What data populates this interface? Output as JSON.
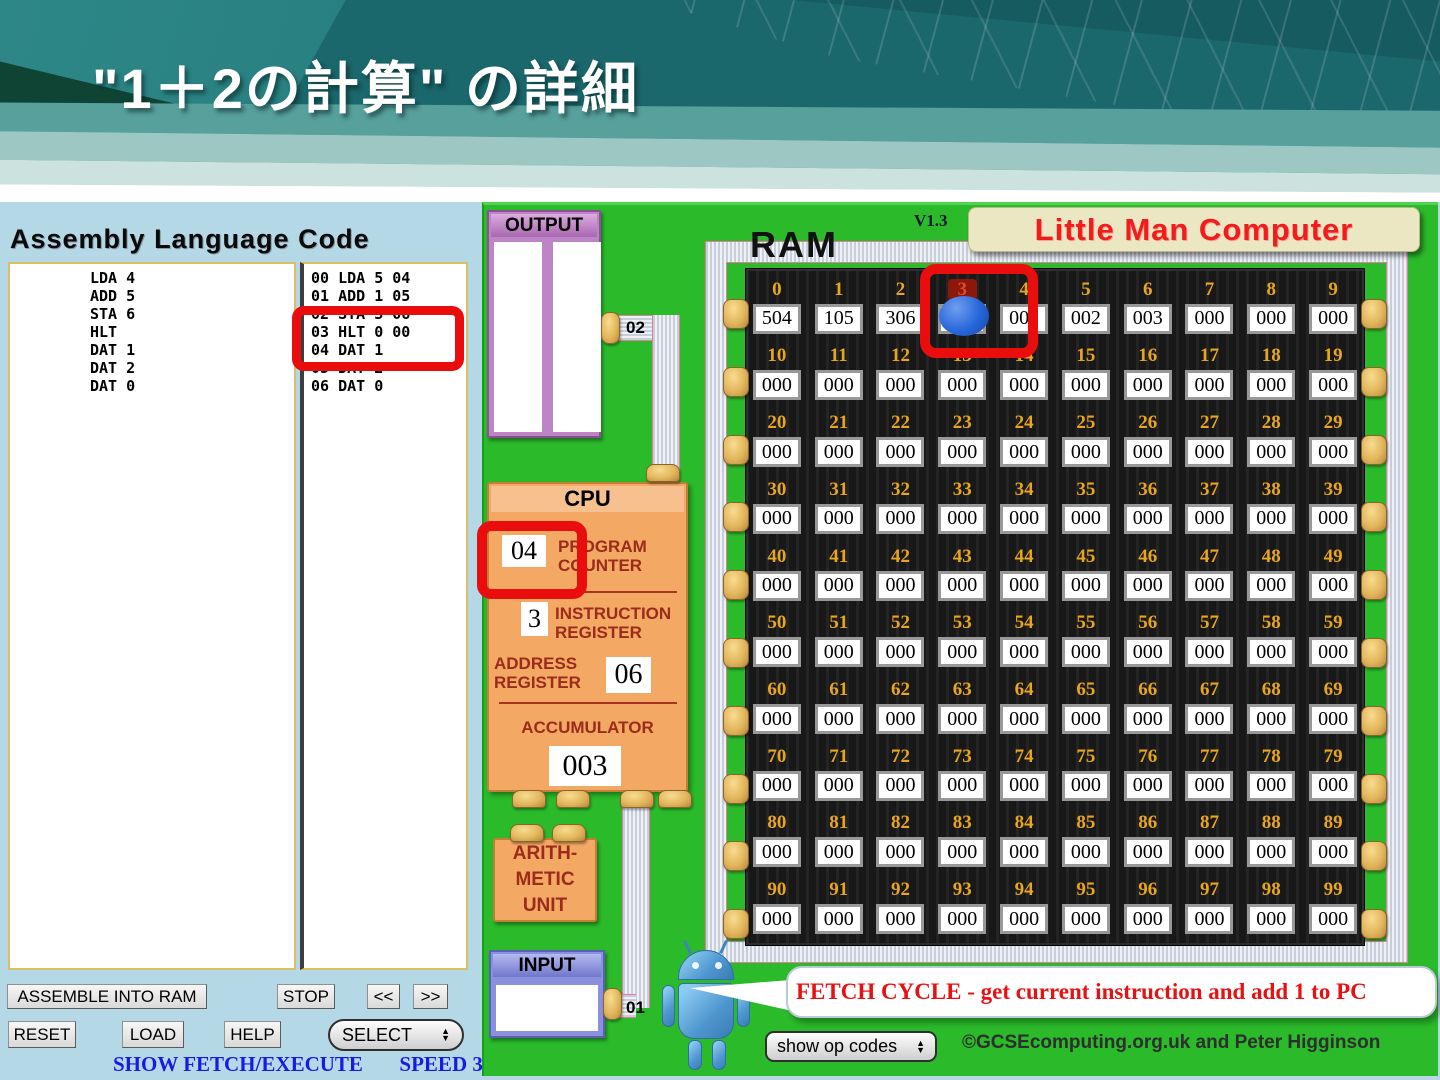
{
  "slide": {
    "title": "\"1＋2の計算\" の詳細"
  },
  "assembly": {
    "heading": "Assembly Language Code",
    "source_lines": [
      "LDA 4",
      "ADD 5",
      "STA 6",
      "HLT",
      "DAT 1",
      "DAT 2",
      "DAT 0"
    ],
    "assembled_lines": [
      "00 LDA 5 04",
      "01 ADD 1 05",
      "02 STA 3 06",
      "03 HLT 0 00",
      "04 DAT 1",
      "05 DAT 2",
      "06 DAT 0"
    ],
    "highlighted_line": "03 HLT 0 00"
  },
  "controls": {
    "assemble_into_ram": "ASSEMBLE INTO RAM",
    "stop": "STOP",
    "step_back": "<<",
    "step_forward": ">>",
    "reset": "RESET",
    "load": "LOAD",
    "help": "HELP",
    "select": "SELECT",
    "show_fetch_execute": "SHOW FETCH/EXECUTE",
    "speed": "SPEED 3"
  },
  "icons": {
    "arrow_up": "▲",
    "arrow_down": "▼"
  },
  "lmc": {
    "version": "V1.3",
    "logo": "Little Man Computer",
    "output": {
      "label": "OUTPUT",
      "port": "02"
    },
    "input": {
      "label": "INPUT",
      "port": "01",
      "value": ""
    },
    "cpu": {
      "title": "CPU",
      "program_counter": {
        "label1": "PROGRAM",
        "label2": "COUNTER",
        "value": "04"
      },
      "instruction_register": {
        "label1": "INSTRUCTION",
        "label2": "REGISTER",
        "value": "3"
      },
      "address_register": {
        "label1": "ADDRESS",
        "label2": "REGISTER",
        "value": "06"
      },
      "accumulator": {
        "label": "ACCUMULATOR",
        "value": "003"
      }
    },
    "alu": {
      "line1": "ARITH-",
      "line2": "METIC",
      "line3": "UNIT"
    },
    "ram": {
      "label": "RAM",
      "highlight_address": "3",
      "rows": [
        {
          "addresses": [
            "0",
            "1",
            "2",
            "3",
            "4",
            "5",
            "6",
            "7",
            "8",
            "9"
          ],
          "values": [
            "504",
            "105",
            "306",
            "000",
            "001",
            "002",
            "003",
            "000",
            "000",
            "000"
          ]
        },
        {
          "addresses": [
            "10",
            "11",
            "12",
            "13",
            "14",
            "15",
            "16",
            "17",
            "18",
            "19"
          ],
          "values": [
            "000",
            "000",
            "000",
            "000",
            "000",
            "000",
            "000",
            "000",
            "000",
            "000"
          ]
        },
        {
          "addresses": [
            "20",
            "21",
            "22",
            "23",
            "24",
            "25",
            "26",
            "27",
            "28",
            "29"
          ],
          "values": [
            "000",
            "000",
            "000",
            "000",
            "000",
            "000",
            "000",
            "000",
            "000",
            "000"
          ]
        },
        {
          "addresses": [
            "30",
            "31",
            "32",
            "33",
            "34",
            "35",
            "36",
            "37",
            "38",
            "39"
          ],
          "values": [
            "000",
            "000",
            "000",
            "000",
            "000",
            "000",
            "000",
            "000",
            "000",
            "000"
          ]
        },
        {
          "addresses": [
            "40",
            "41",
            "42",
            "43",
            "44",
            "45",
            "46",
            "47",
            "48",
            "49"
          ],
          "values": [
            "000",
            "000",
            "000",
            "000",
            "000",
            "000",
            "000",
            "000",
            "000",
            "000"
          ]
        },
        {
          "addresses": [
            "50",
            "51",
            "52",
            "53",
            "54",
            "55",
            "56",
            "57",
            "58",
            "59"
          ],
          "values": [
            "000",
            "000",
            "000",
            "000",
            "000",
            "000",
            "000",
            "000",
            "000",
            "000"
          ]
        },
        {
          "addresses": [
            "60",
            "61",
            "62",
            "63",
            "64",
            "65",
            "66",
            "67",
            "68",
            "69"
          ],
          "values": [
            "000",
            "000",
            "000",
            "000",
            "000",
            "000",
            "000",
            "000",
            "000",
            "000"
          ]
        },
        {
          "addresses": [
            "70",
            "71",
            "72",
            "73",
            "74",
            "75",
            "76",
            "77",
            "78",
            "79"
          ],
          "values": [
            "000",
            "000",
            "000",
            "000",
            "000",
            "000",
            "000",
            "000",
            "000",
            "000"
          ]
        },
        {
          "addresses": [
            "80",
            "81",
            "82",
            "83",
            "84",
            "85",
            "86",
            "87",
            "88",
            "89"
          ],
          "values": [
            "000",
            "000",
            "000",
            "000",
            "000",
            "000",
            "000",
            "000",
            "000",
            "000"
          ]
        },
        {
          "addresses": [
            "90",
            "91",
            "92",
            "93",
            "94",
            "95",
            "96",
            "97",
            "98",
            "99"
          ],
          "values": [
            "000",
            "000",
            "000",
            "000",
            "000",
            "000",
            "000",
            "000",
            "000",
            "000"
          ]
        }
      ]
    },
    "status_message": "FETCH CYCLE - get current instruction and add 1 to PC",
    "show_op_codes": "show op codes",
    "credits": "©GCSEcomputing.org.uk and Peter Higginson"
  },
  "colors": {
    "annotation_red": "#ea0d0d",
    "panel_green": "#2aba2a",
    "cpu_orange": "#f3a963",
    "cpu_label_red": "#9b2b1b",
    "ram_address_gold": "#e8a51f",
    "logo_red": "#f11c1c",
    "message_red": "#e81010",
    "status_blue": "#1a1ae6",
    "fetch_ball_blue": "#2766d9",
    "output_purple": "#bd84c6",
    "input_periwinkle": "#8a90dd",
    "background_blue": "#b5d8e6"
  }
}
